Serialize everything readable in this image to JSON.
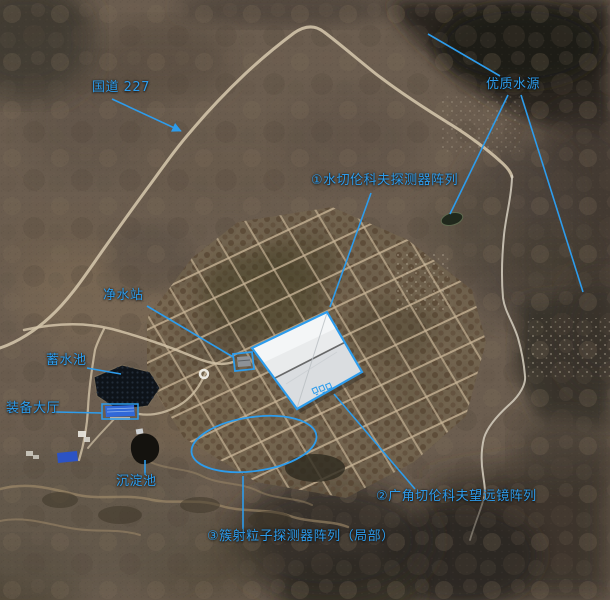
{
  "colors": {
    "annotation": "#2d9cec"
  },
  "labels": {
    "highway": "国道 227",
    "water_source": "优质水源",
    "detector_array_1": "①水切伦科夫探测器阵列",
    "purification_station": "净水站",
    "reservoir": "蓄水池",
    "equipment_hall": "装备大厅",
    "sedimentation_pool": "沉淀池",
    "telescope_array_2": "②广角切伦科夫望远镜阵列",
    "shower_detector_3": "③簇射粒子探测器阵列（局部）"
  }
}
